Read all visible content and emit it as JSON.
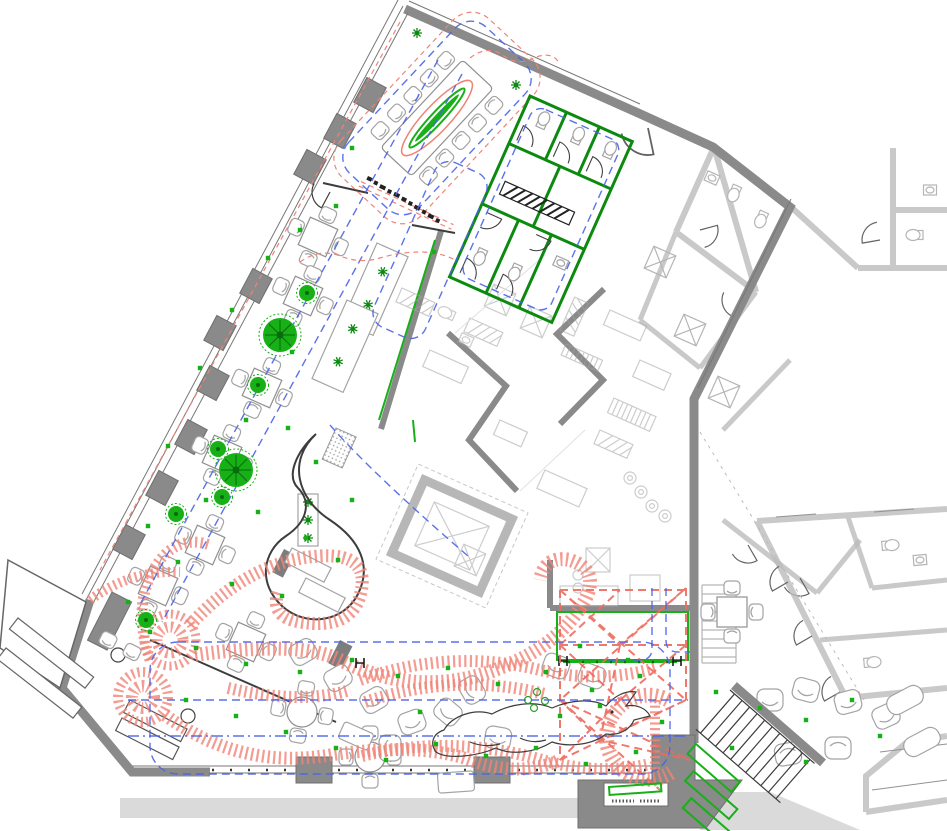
{
  "drawing": {
    "kind": "architectural-floor-plan",
    "sheet_title": "Restaurant ground floor plan with furniture, services and mural layers",
    "colors": {
      "paper": "#ffffff",
      "wall_main": "#8a8a8a",
      "wall_neighbor": "#bcbcbc",
      "line_dark": "#3d3d3d",
      "line_furniture": "#a3a3a3",
      "services_blue": "#4a63e8",
      "mural_red": "#f08377",
      "net_red": "#ee6a5e",
      "plant_green": "#17b017",
      "plant_green_dark": "#0c8a10",
      "sidewalk": "#dadada"
    },
    "layers": {
      "walls": "structural walls",
      "glazing": "glazed street facade with piers",
      "furniture": "tables, chairs, lounge seating",
      "services": "blue dashed ceiling services loops",
      "mural": "red hatched octopus wave mural",
      "net": "red dashed net installation",
      "planting": "green planters, trees and markers",
      "stairs": "internal and external stairs",
      "kitchen": "back of house kitchen equipment",
      "restrooms": "green outlined WC block",
      "neighbor": "adjacent building (ghosted)",
      "whale": "hand sketched whale with bubbles",
      "annotation": "illegible pen annotation along red guide"
    }
  }
}
